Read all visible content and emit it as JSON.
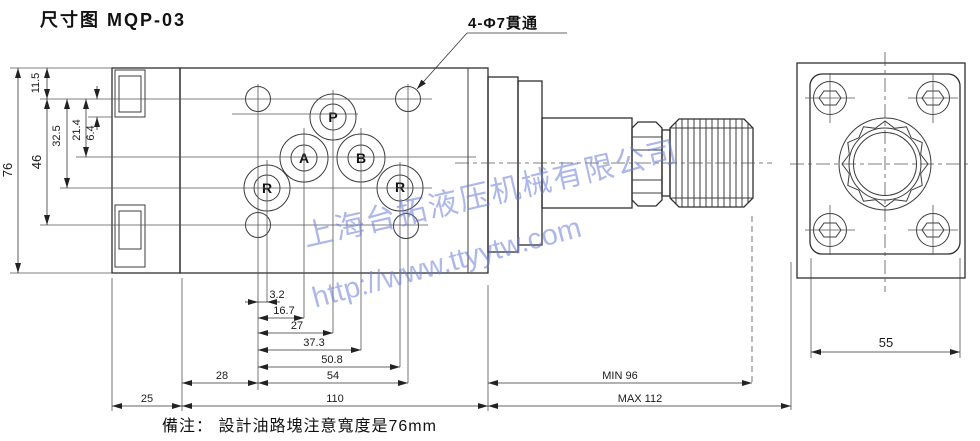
{
  "title": "尺寸图 MQP-03",
  "callout": "4-Φ7貫通",
  "note": "備注： 設計油路塊注意寬度是76mm",
  "watermark": {
    "company": "上海台拓液压机械有限公司",
    "url": "http://www.ttyytw.com",
    "color": "#6a7ed5"
  },
  "ports": {
    "p": "P",
    "a": "A",
    "b": "B",
    "r_left": "R",
    "r_right": "R"
  },
  "dims": {
    "total_height": "76",
    "bolt_rows_spacing": "46",
    "h_32_5": "32.5",
    "h_21_4": "21.4",
    "h_11_5": "11.5",
    "h_6_4": "6.4",
    "w_3_2": "3.2",
    "w_16_7": "16.7",
    "w_27": "27",
    "w_37_3": "37.3",
    "w_50_8": "50.8",
    "w_54": "54",
    "w_28": "28",
    "w_25": "25",
    "w_110": "110",
    "min_length": "MIN 96",
    "max_length": "MAX 112",
    "flange_width": "55"
  }
}
